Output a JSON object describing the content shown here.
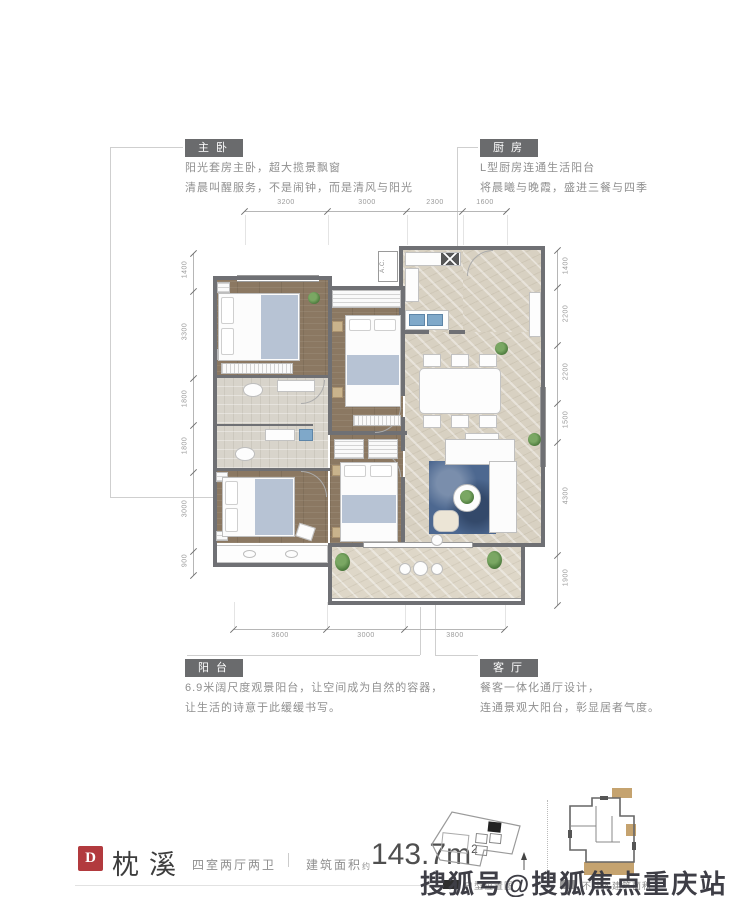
{
  "callouts": {
    "master_bedroom": {
      "title": "主卧",
      "line1": "阳光套房主卧，超大揽景飘窗",
      "line2": "清晨叫醒服务，不是闹钟，而是清风与阳光"
    },
    "kitchen": {
      "title": "厨房",
      "line1": "L型厨房连通生活阳台",
      "line2": "将晨曦与晚霞，盛进三餐与四季"
    },
    "balcony": {
      "title": "阳台",
      "line1": "6.9米阔尺度观景阳台，让空间成为自然的容器，",
      "line2": "让生活的诗意于此缓缓书写。"
    },
    "living_room": {
      "title": "客厅",
      "line1": "餐客一体化通厅设计，",
      "line2": "连通景观大阳台，彰显居者气度。"
    }
  },
  "dimensions": {
    "top": [
      "3200",
      "3000",
      "2300",
      "1600"
    ],
    "bottom": [
      "3600",
      "3000",
      "3800"
    ],
    "left": [
      "1400",
      "3300",
      "1800",
      "1800",
      "3000",
      "900"
    ],
    "right": [
      "1400",
      "2200",
      "2200",
      "1500",
      "4300",
      "1900"
    ]
  },
  "plan": {
    "ac_label": "A.C."
  },
  "footer": {
    "unit_letter": "D",
    "unit_name": "枕溪",
    "layout": "四室两厅两卫",
    "area_label": "建筑面积",
    "area_approx": "约",
    "area_value": "143.7m",
    "area_sup": "2",
    "legend_location": "户型位置图",
    "legend_right": "不计入建筑面积"
  },
  "watermark": "搜狐号@搜狐焦点重庆站",
  "colors": {
    "tag_background": "#6a6b6d",
    "badge_red": "#b23a3e",
    "wall": "#6f7074",
    "wood_floor": "#8b7862",
    "marble_floor": "#d8d1c2",
    "rug_blue": "#4d6890",
    "highlight_tan": "#c5a36f",
    "watermark_gray": "#3e3e46"
  }
}
